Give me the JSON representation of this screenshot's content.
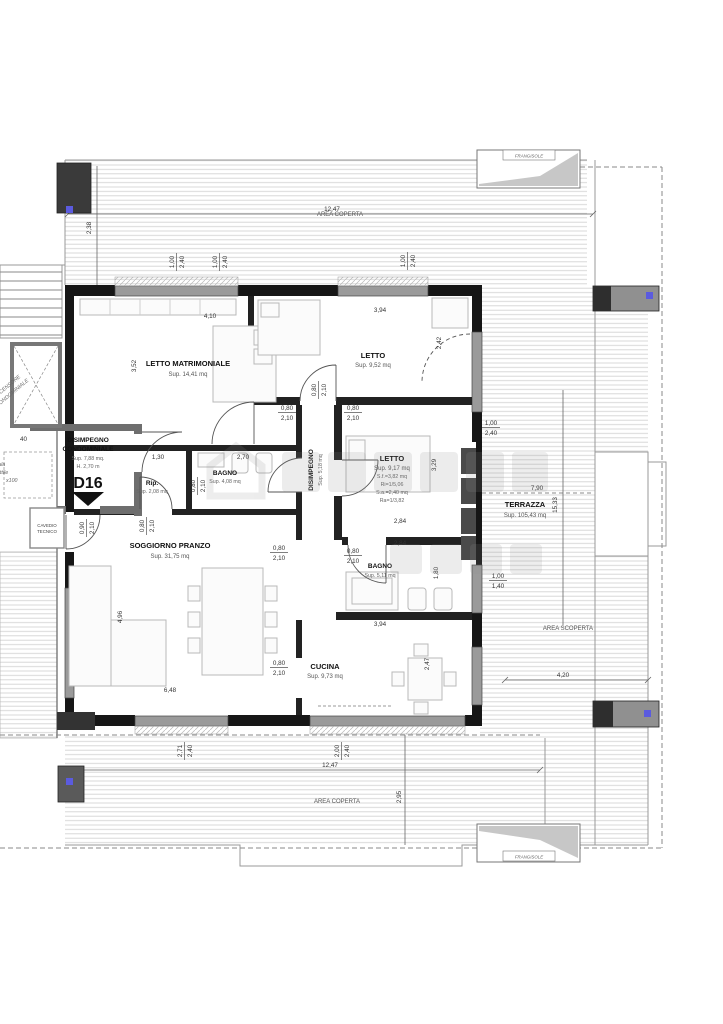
{
  "colors": {
    "wall": "#161616",
    "core_wall": "#6e6e6e",
    "window": "#9a9a9a",
    "hatch_line": "#d4d4d4",
    "marker_blue": "#5b5bdf"
  },
  "unit": {
    "id": "D16"
  },
  "labels": {
    "area_coperta": "AREA COPERTA",
    "area_coperta_2": "AREA COPERTA",
    "area_scoperta": "AREA SCOPERTA",
    "frangisole": "FRANGISOLE",
    "terrazza": "TERRAZZA",
    "terrazza_sup": "Sup. 105,43 mq",
    "letto_matrimoniale": "LETTO MATRIMONIALE",
    "letto_matrimoniale_sup": "Sup. 14,41 mq",
    "letto_1": "LETTO",
    "letto_1_sup": "Sup. 9,52 mq",
    "letto_2": "LETTO",
    "letto_2_sup": "Sup. 9,17 mq",
    "letto_2_sf": "S.f.=3,82 mq",
    "letto_2_ri": "Ri=1/5,06",
    "letto_2_sa": "S.a.=2,40 mq",
    "letto_2_ra": "Ra=1/3,82",
    "bagno_1": "BAGNO",
    "bagno_1_sup": "Sup. 4,08 mq",
    "bagno_2": "BAGNO",
    "bagno_2_sup": "Sup. 5,11 mq",
    "rip": "Rip.",
    "rip_sup": "Sup. 2,08 mq",
    "disimpegno": "DISIMPEGNO",
    "disimpegno_sup": "Sup. 5,18 mq",
    "soggiorno": "SOGGIORNO PRANZO",
    "soggiorno_sup": "Sup. 31,75 mq",
    "cucina": "CUCINA",
    "cucina_sup": "Sup. 9,73 mq",
    "disimpegno_condominiale_1": "DISIMPEGNO",
    "disimpegno_condominiale_2": "CONDOMINIALE",
    "disimpegno_condominiale_sup": "Sup. 7,88 mq.",
    "disimpegno_condominiale_h": "H. 2,70 m",
    "cavedio_1": "CAVEDIO",
    "cavedio_2": "TECNICO",
    "ascensore_1": "ASCENSORE",
    "ascensore_2": "CONDOMINIALE",
    "scala_1": "Scala",
    "scala_2": "retrattile",
    "scala_3": "x100"
  },
  "dims": {
    "d1247": "12,47",
    "d238": "2,38",
    "d100": "1,00",
    "d240": "2,40",
    "d140": "1,40",
    "d410": "4,10",
    "d352": "3,52",
    "d394": "3,94",
    "d242": "2,42",
    "d080": "0,80",
    "d210": "2,10",
    "d090": "0,90",
    "d270": "2,70",
    "d130": "1,30",
    "d329": "3,29",
    "d284": "2,84",
    "d790": "7,90",
    "d1533": "15,33",
    "d496": "4,96",
    "d648": "6,48",
    "d180": "1,80",
    "d247": "2,47",
    "d420": "4,20",
    "d271": "2,71",
    "d200": "2,00",
    "d295": "2,95",
    "d40": "40"
  }
}
